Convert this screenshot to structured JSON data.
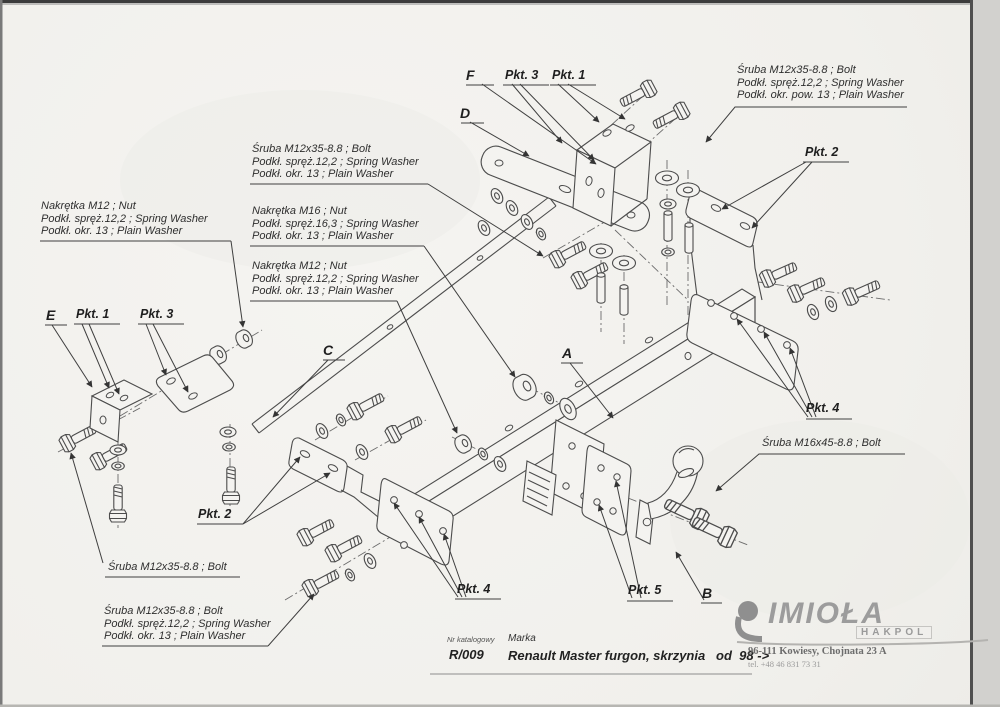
{
  "colors": {
    "paper": "#f3f2ef",
    "ink": "#3f3f3f",
    "brand_gray": "#9c9c9c"
  },
  "notes": {
    "top_right": {
      "lines": [
        "Śruba M12x35-8.8 ;  Bolt",
        "Podkł. spręż.12,2 ; Spring Washer",
        "Podkł. okr. pow. 13 ; Plain Washer"
      ]
    },
    "mid_bolt": {
      "lines": [
        "Śruba M12x35-8.8 ;  Bolt",
        "Podkł. spręż.12,2 ; Spring Washer",
        "Podkł. okr. 13 ; Plain Washer"
      ]
    },
    "mid_nut_m16": {
      "lines": [
        "Nakrętka  M16 ; Nut",
        "Podkł. spręż.16,3 ; Spring Washer",
        "Podkł. okr. 13 ; Plain Washer"
      ]
    },
    "left_nut_m12": {
      "lines": [
        "Nakrętka  M12 ; Nut",
        "Podkł. spręż.12,2 ; Spring Washer",
        "Podkł. okr. 13 ; Plain Washer"
      ]
    },
    "mid_nut_m12": {
      "lines": [
        "Nakrętka  M12 ; Nut",
        "Podkł. spręż.12,2 ; Spring Washer",
        "Podkł. okr. 13 ; Plain Washer"
      ]
    },
    "bottom_bolt": {
      "lines": [
        "Śruba M12x35-8.8 ;  Bolt"
      ]
    },
    "bottom_bolt_full": {
      "lines": [
        "Śruba M12x35-8.8 ;  Bolt",
        "Podkł. spręż.12,2 ; Spring Washer",
        "Podkł. okr. 13 ; Plain Washer"
      ]
    },
    "right_bolt_m16": {
      "lines": [
        "Śruba M16x45-8.8 ;  Bolt"
      ]
    }
  },
  "ref_labels": {
    "a": "A",
    "b": "B",
    "c": "C",
    "d": "D",
    "e": "E",
    "f": "F"
  },
  "point_labels": {
    "pkt1": "Pkt. 1",
    "pkt2": "Pkt. 2",
    "pkt3": "Pkt. 3",
    "pkt4": "Pkt. 4",
    "pkt5": "Pkt. 5"
  },
  "title_block": {
    "catalog_label": "Nr katalogowy",
    "catalog_number": "R/009",
    "brand_label": "Marka",
    "vehicle": "Renault Master furgon, skrzynia   od  98 ->"
  },
  "brand": {
    "name": "IMIOŁA",
    "sub": "HAKPOL",
    "address": "96-111 Kowiesy, Chojnata 23 A",
    "phone": "tel. +48 46 831 73 31"
  }
}
